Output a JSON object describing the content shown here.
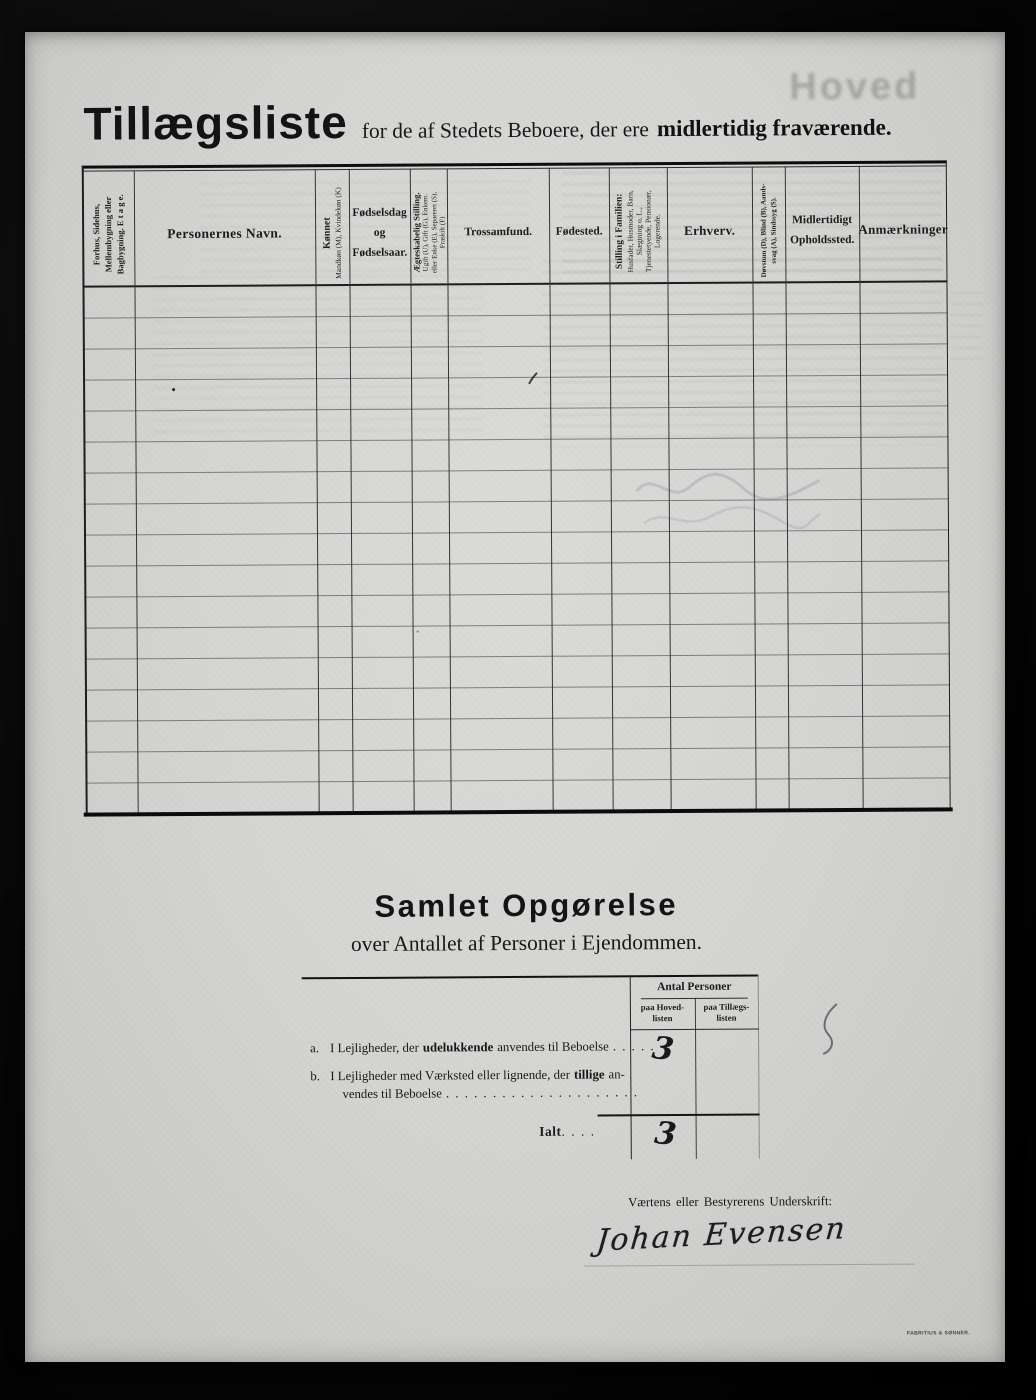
{
  "title": {
    "main": "Tillægsliste",
    "mid": "for de af Stedets Beboere, der ere",
    "emphasis": "midlertidig fraværende."
  },
  "ghost": {
    "bleed_title": "Hoved"
  },
  "table": {
    "columns": [
      {
        "label": "Forhus, Sidehus,\nMellembygning eller\nBagbygning.   E t a g e."
      },
      {
        "label": "Personernes Navn."
      },
      {
        "label": "Kønnet",
        "sub": "Mandkøn (M), Kvindekøn (K)"
      },
      {
        "label": "Fødselsdag\nog\nFødselsaar."
      },
      {
        "label": "Ægteskabelig Stilling.",
        "sub": "Ugift (U), Gift (G), Enkem.\neller Enke (E), Separeret (S),\nFraskilt (F)"
      },
      {
        "label": "Trossamfund."
      },
      {
        "label": "Fødested."
      },
      {
        "label": "Stilling i Familien:",
        "sub": "Husfader, Husmoder, Barn,\nSlægtning o. L.,\nTjenestetyende, Pensionær,\nLogerende."
      },
      {
        "label": "Erhverv."
      },
      {
        "label": "Døvstum (D), Blind (B), Aands-\nsvag (A), Sindssyg (S)."
      },
      {
        "label": "Midlertidigt\nOpholdssted."
      },
      {
        "label": "Anmærkninger"
      }
    ]
  },
  "summary": {
    "title": "Samlet Opgørelse",
    "subtitle": "over Antallet af Personer i Ejendommen.",
    "group_header": "Antal Personer",
    "col_hoved": "paa Hoved-\nlisten",
    "col_tillaegs": "paa Tillægs-\nlisten",
    "row_a": {
      "index": "a.",
      "pre": "I Lejligheder, der",
      "bold": "udelukkende",
      "post": "anvendes til Beboelse",
      "dots": ". . . . .",
      "value_hoved": "3"
    },
    "row_b": {
      "index": "b.",
      "pre": "I Lejligheder med Værksted eller lignende, der",
      "bold": "tillige",
      "post": "an-",
      "line2": "vendes til Beboelse",
      "dots": ". . . . . . . . . . . . . . . . . . . . ."
    },
    "total": {
      "label": "Ialt",
      "dots": ". . . .",
      "value_hoved": "3"
    }
  },
  "signature": {
    "label": "Værtens eller Bestyrerens Underskrift:",
    "name": "Johan Evensen"
  },
  "printer_mark": "FABRITIUS & SØNNER."
}
